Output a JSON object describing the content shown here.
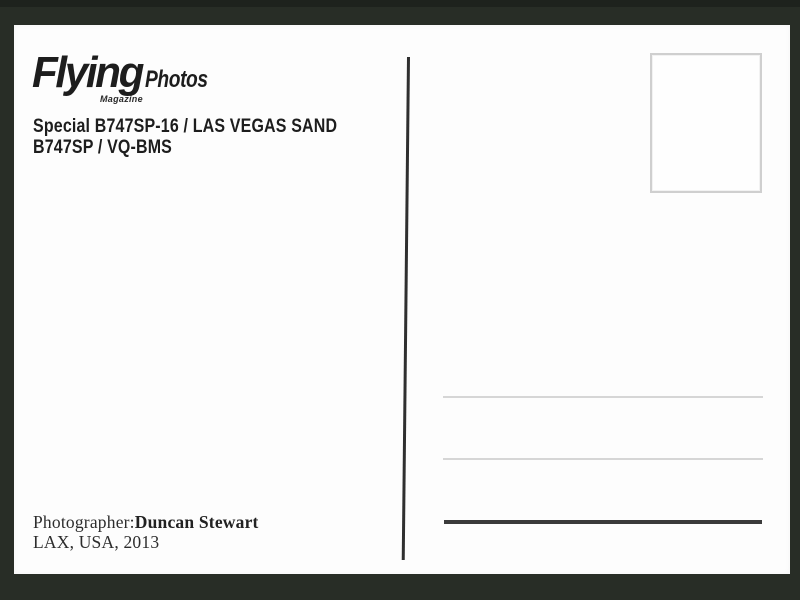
{
  "colors": {
    "frame_background": "#282d26",
    "card_background": "#fdfdfd",
    "ink": "#1d1d1d",
    "stamp_border": "#cfcfcf",
    "address_line_light": "#d6d6d6",
    "address_line_dark": "#3b3b3b",
    "divider": "#2f2f2f"
  },
  "logo": {
    "brand": "Flying",
    "suffix": "Photos",
    "tagline": "Magazine"
  },
  "caption": {
    "line1": "Special B747SP-16 / LAS VEGAS SAND",
    "line2": "B747SP / VQ-BMS"
  },
  "credit": {
    "label": "Photographer:",
    "name": "Duncan Stewart",
    "location": "LAX, USA, 2013"
  }
}
